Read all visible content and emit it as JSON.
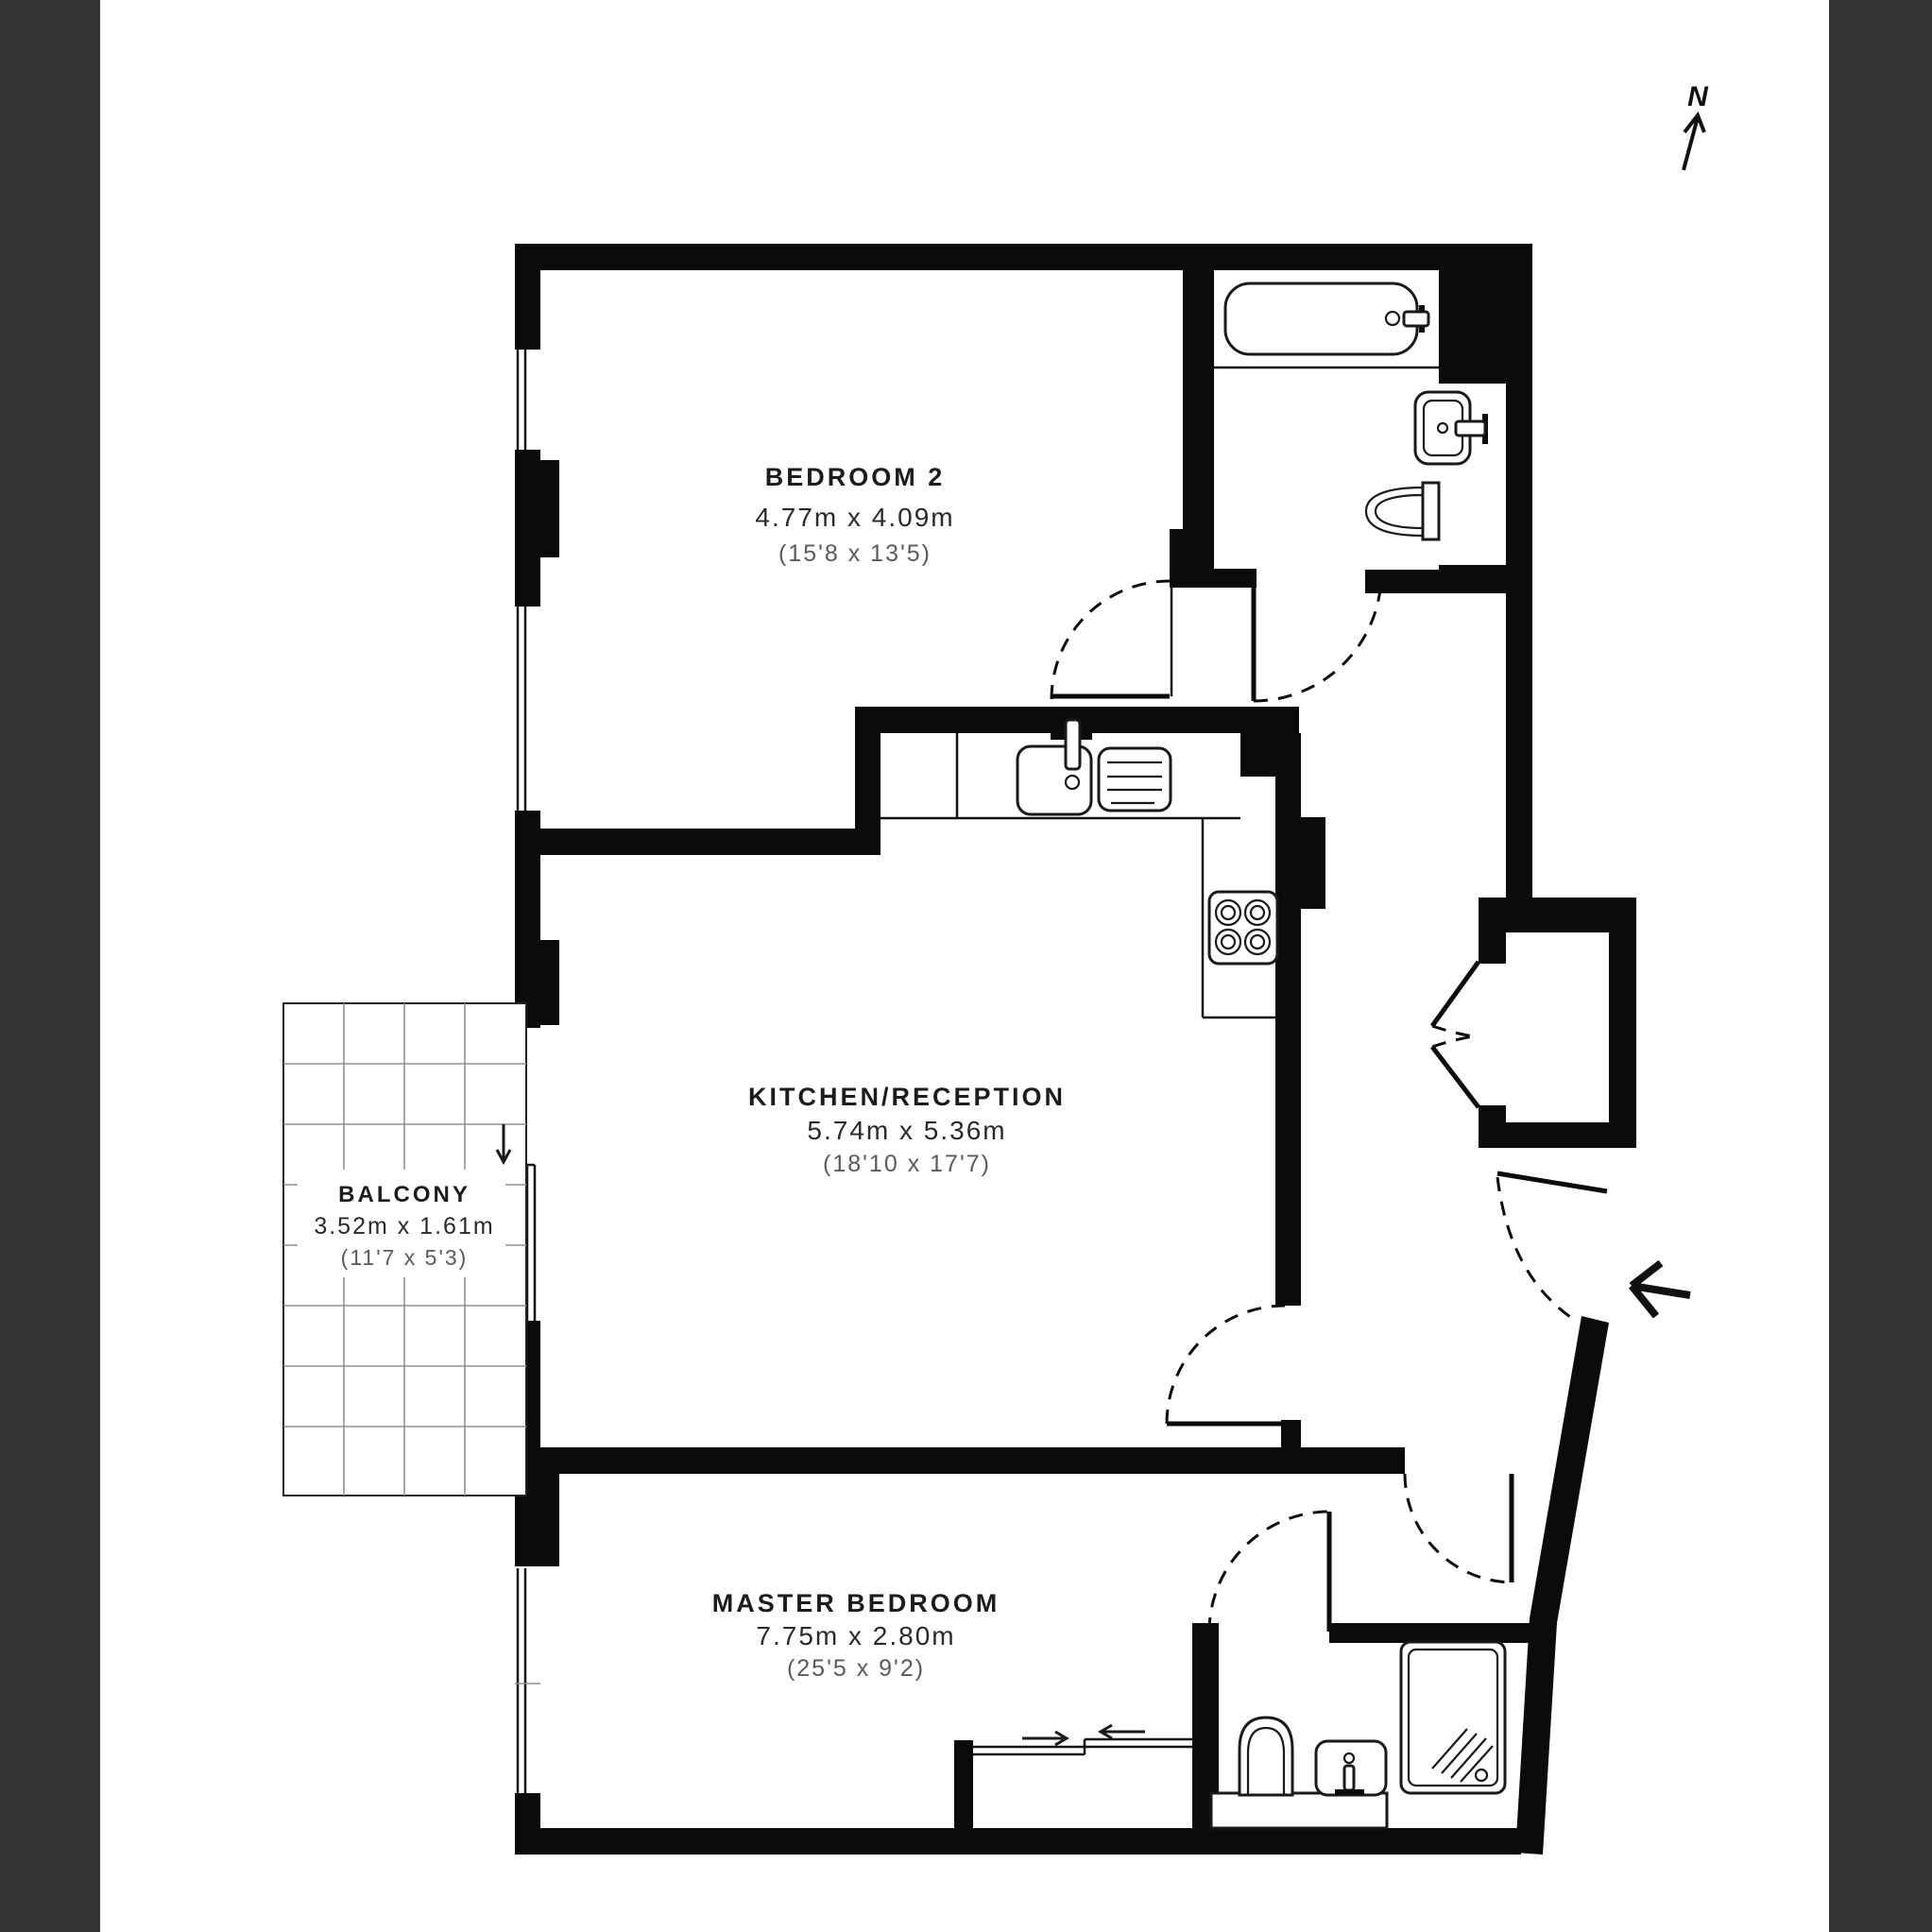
{
  "page": {
    "background": "#ffffff",
    "side_panel_color": "#333333",
    "wall_color": "#0b0b0b",
    "grid_color": "#8f8f8f",
    "dim_text_color": "#2a2a2a",
    "ft_text_color": "#5a5a5a"
  },
  "compass": {
    "label": "N"
  },
  "rooms": [
    {
      "id": "bedroom2",
      "name": "BEDROOM 2",
      "dimensions_m": "4.77m x 4.09m",
      "dimensions_ft": "(15'8 x 13'5)"
    },
    {
      "id": "kitchen_reception",
      "name": "KITCHEN/RECEPTION",
      "dimensions_m": "5.74m x 5.36m",
      "dimensions_ft": "(18'10 x 17'7)"
    },
    {
      "id": "balcony",
      "name": "BALCONY",
      "dimensions_m": "3.52m x 1.61m",
      "dimensions_ft": "(11'7 x 5'3)"
    },
    {
      "id": "master_bedroom",
      "name": "MASTER BEDROOM",
      "dimensions_m": "7.75m x 2.80m",
      "dimensions_ft": "(25'5 x 9'2)"
    }
  ],
  "fixtures": [
    "bathtub",
    "bathroom-basin",
    "bathroom-toilet",
    "kitchen-sink",
    "kitchen-drainer",
    "kitchen-hob",
    "ensuite-toilet",
    "ensuite-basin",
    "ensuite-shower",
    "hall-closet",
    "wardrobe-sliding-doors"
  ]
}
